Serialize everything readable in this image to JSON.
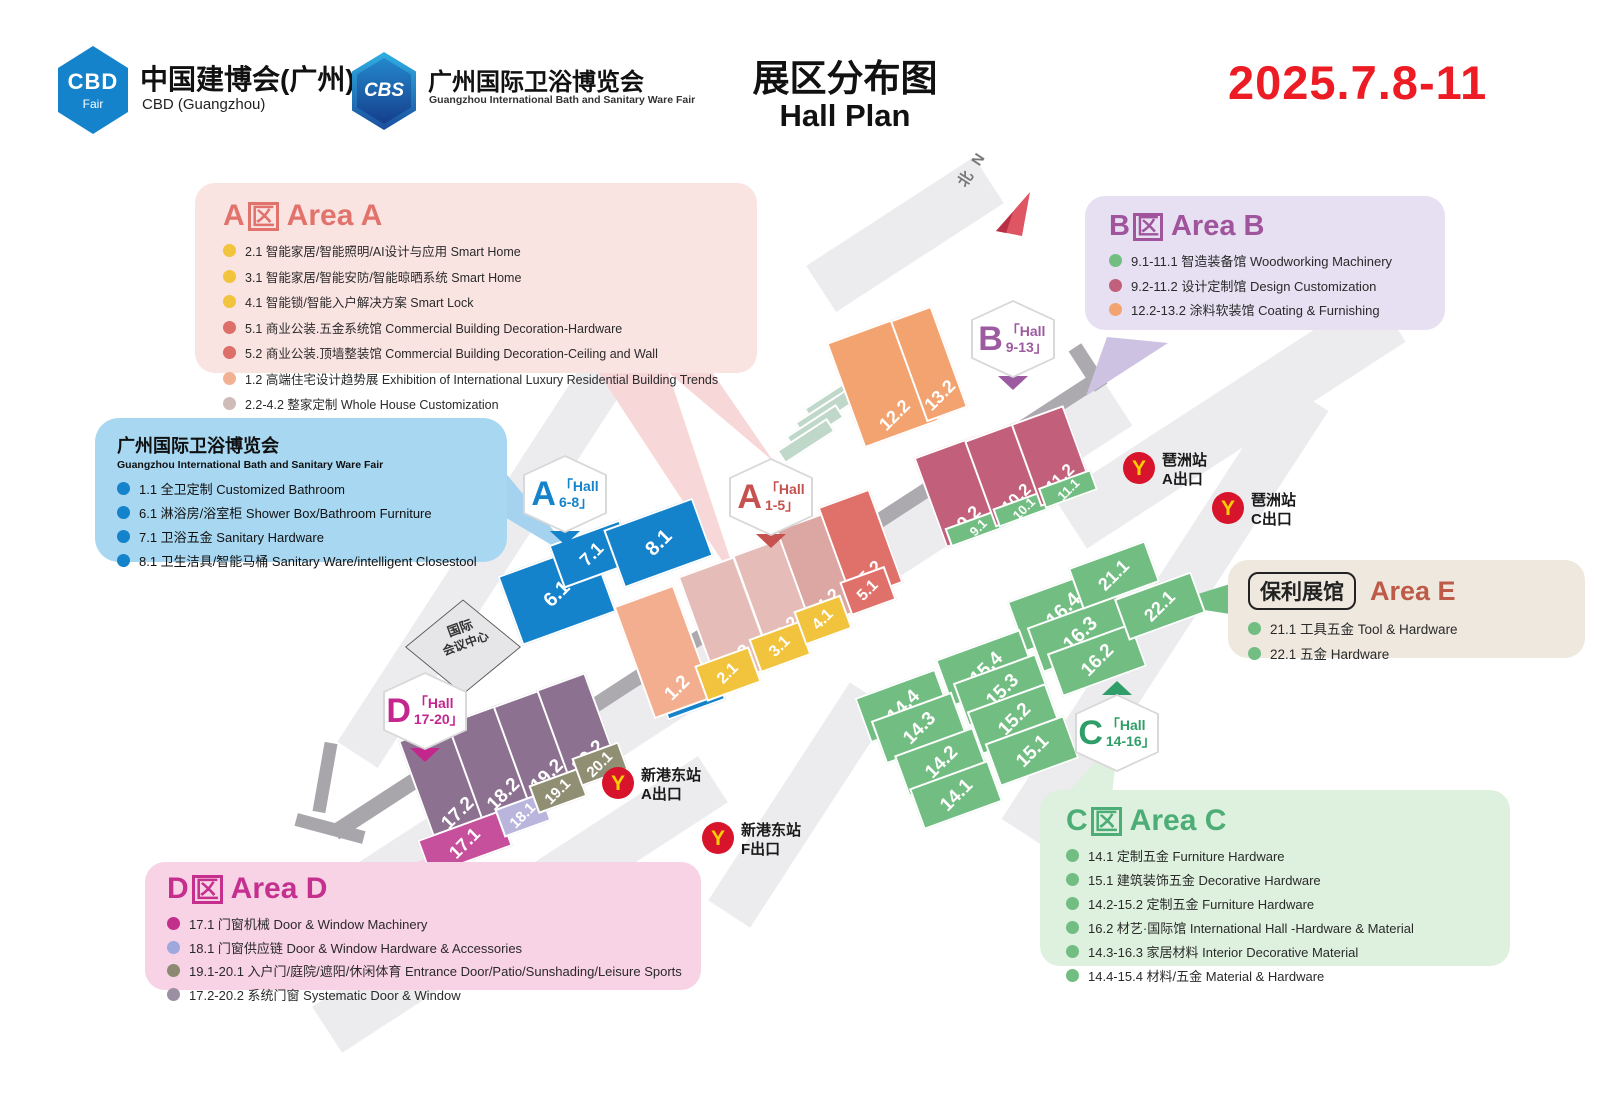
{
  "header": {
    "cbd_logo": {
      "text": "CBD",
      "sub": "Fair"
    },
    "cbd_title": "中国建博会(广州)",
    "cbd_subtitle": "CBD (Guangzhou)",
    "cbs_logo": "CBS",
    "cbs_title": "广州国际卫浴博览会",
    "cbs_subtitle": "Guangzhou International Bath and Sanitary Ware Fair",
    "title_zh": "展区分布图",
    "title_en": "Hall Plan",
    "date": "2025.7.8-11"
  },
  "legends": {
    "a": {
      "letter": "A",
      "qu": "区",
      "title": "Area A",
      "items": [
        {
          "color": "#F2C33D",
          "text": "2.1 智能家居/智能照明/AI设计与应用 Smart Home"
        },
        {
          "color": "#F2C33D",
          "text": "3.1 智能家居/智能安防/智能晾晒系统 Smart Home"
        },
        {
          "color": "#F2C33D",
          "text": "4.1 智能锁/智能入户解决方案 Smart Lock"
        },
        {
          "color": "#DD6E68",
          "text": "5.1 商业公装.五金系统馆 Commercial Building Decoration-Hardware"
        },
        {
          "color": "#DD6E68",
          "text": "5.2 商业公装.顶墙整装馆 Commercial Building Decoration-Ceiling and Wall"
        },
        {
          "color": "#F2B193",
          "text": "1.2 高端住宅设计趋势展 Exhibition of International Luxury Residential Building Trends"
        },
        {
          "color": "#CFBCB9",
          "text": "2.2-4.2 整家定制 Whole House Customization"
        }
      ]
    },
    "bath": {
      "title": "广州国际卫浴博览会",
      "subtitle": "Guangzhou International Bath and Sanitary Ware Fair",
      "items": [
        {
          "color": "#1583CB",
          "text": "1.1 全卫定制 Customized Bathroom"
        },
        {
          "color": "#1583CB",
          "text": "6.1 淋浴房/浴室柜 Shower Box/Bathroom Furniture"
        },
        {
          "color": "#1583CB",
          "text": "7.1 卫浴五金 Sanitary Hardware"
        },
        {
          "color": "#1583CB",
          "text": "8.1 卫生洁具/智能马桶 Sanitary Ware/intelligent Closestool"
        }
      ]
    },
    "b": {
      "letter": "B",
      "qu": "区",
      "title": "Area B",
      "items": [
        {
          "color": "#72BE82",
          "text": "9.1-11.1 智造装备馆 Woodworking Machinery"
        },
        {
          "color": "#C2607C",
          "text": "9.2-11.2 设计定制馆 Design Customization"
        },
        {
          "color": "#F3A370",
          "text": "12.2-13.2 涂料软装馆 Coating & Furnishing"
        }
      ]
    },
    "e": {
      "pill": "保利展馆",
      "title": "Area E",
      "items": [
        {
          "color": "#72BE82",
          "text": "21.1 工具五金 Tool & Hardware"
        },
        {
          "color": "#72BE82",
          "text": "22.1 五金 Hardware"
        }
      ]
    },
    "c": {
      "letter": "C",
      "qu": "区",
      "title": "Area C",
      "items": [
        {
          "color": "#72BE82",
          "text": "14.1 定制五金 Furniture Hardware"
        },
        {
          "color": "#72BE82",
          "text": "15.1 建筑装饰五金 Decorative Hardware"
        },
        {
          "color": "#72BE82",
          "text": "14.2-15.2 定制五金 Furniture Hardware"
        },
        {
          "color": "#72BE82",
          "text": "16.2 材艺·国际馆 International Hall -Hardware & Material"
        },
        {
          "color": "#72BE82",
          "text": "14.3-16.3 家居材料 Interior Decorative Material"
        },
        {
          "color": "#72BE82",
          "text": "14.4-15.4 材料/五金 Material & Hardware"
        }
      ]
    },
    "d": {
      "letter": "D",
      "qu": "区",
      "title": "Area D",
      "items": [
        {
          "color": "#C2308C",
          "text": "17.1 门窗机械 Door & Window Machinery"
        },
        {
          "color": "#9FA8DC",
          "text": "18.1 门窗供应链 Door & Window Hardware & Accessories"
        },
        {
          "color": "#8B8A70",
          "text": "19.1-20.1 入户门/庭院/遮阳/休闲体育 Entrance Door/Patio/Sunshading/Leisure Sports"
        },
        {
          "color": "#9B8FA3",
          "text": "17.2-20.2 系统门窗 Systematic Door & Window"
        }
      ]
    }
  },
  "map": {
    "north": "北 N",
    "convention_center": {
      "line1": "国际",
      "line2": "会议中心"
    },
    "halls": [
      {
        "label": "6.1",
        "x": 557,
        "y": 594,
        "w": 100,
        "h": 74,
        "c": "#1583CB",
        "fs": 20
      },
      {
        "label": "7.1",
        "x": 592,
        "y": 554,
        "w": 76,
        "h": 46,
        "c": "#1583CB",
        "fs": 18
      },
      {
        "label": "8.1",
        "x": 658,
        "y": 543,
        "w": 95,
        "h": 62,
        "c": "#1583CB",
        "fs": 20
      },
      {
        "label": "1.1",
        "x": 692,
        "y": 696,
        "w": 62,
        "h": 30,
        "c": "#1583CB",
        "fs": 15
      },
      {
        "label": "1.2",
        "x": 664,
        "y": 652,
        "w": 64,
        "h": 120,
        "c": "#F3AE8F",
        "fs": 19,
        "lp": "b"
      },
      {
        "label": "2.2",
        "x": 726,
        "y": 622,
        "w": 60,
        "h": 118,
        "c": "#E5BCB8",
        "fs": 19,
        "lp": "b"
      },
      {
        "label": "2.1",
        "x": 728,
        "y": 674,
        "w": 58,
        "h": 38,
        "c": "#F2C33D",
        "fs": 16
      },
      {
        "label": "3.2",
        "x": 776,
        "y": 597,
        "w": 54,
        "h": 108,
        "c": "#E5BCB8",
        "fs": 18,
        "lp": "b"
      },
      {
        "label": "3.1",
        "x": 780,
        "y": 647,
        "w": 54,
        "h": 36,
        "c": "#F2C33D",
        "fs": 16
      },
      {
        "label": "4.2",
        "x": 818,
        "y": 570,
        "w": 52,
        "h": 105,
        "c": "#DCA7A2",
        "fs": 18,
        "lp": "b"
      },
      {
        "label": "4.1",
        "x": 823,
        "y": 620,
        "w": 50,
        "h": 36,
        "c": "#F2C33D",
        "fs": 16
      },
      {
        "label": "5.2",
        "x": 860,
        "y": 545,
        "w": 55,
        "h": 100,
        "c": "#E0716A",
        "fs": 18,
        "lp": "b"
      },
      {
        "label": "5.1",
        "x": 868,
        "y": 591,
        "w": 48,
        "h": 36,
        "c": "#E0716A",
        "fs": 16
      },
      {
        "label": "12.2",
        "x": 883,
        "y": 382,
        "w": 80,
        "h": 112,
        "c": "#F3A370",
        "fs": 18,
        "lp": "b"
      },
      {
        "label": "13.2",
        "x": 929,
        "y": 364,
        "w": 44,
        "h": 108,
        "c": "#F3A370",
        "fs": 18,
        "lp": "b"
      },
      {
        "label": "9.2",
        "x": 960,
        "y": 492,
        "w": 64,
        "h": 96,
        "c": "#C2607C",
        "fs": 18,
        "lp": "b"
      },
      {
        "label": "9.1",
        "x": 978,
        "y": 527,
        "w": 64,
        "h": 20,
        "c": "#72BE82",
        "fs": 13
      },
      {
        "label": "10.2",
        "x": 1008,
        "y": 474,
        "w": 60,
        "h": 92,
        "c": "#C2607C",
        "fs": 17,
        "lp": "b"
      },
      {
        "label": "10.1",
        "x": 1024,
        "y": 508,
        "w": 60,
        "h": 20,
        "c": "#72BE82",
        "fs": 13
      },
      {
        "label": "11.2",
        "x": 1052,
        "y": 456,
        "w": 56,
        "h": 88,
        "c": "#C2607C",
        "fs": 17,
        "lp": "b"
      },
      {
        "label": "11.1",
        "x": 1068,
        "y": 489,
        "w": 56,
        "h": 22,
        "c": "#72BE82",
        "fs": 13
      },
      {
        "label": "16.4",
        "x": 1063,
        "y": 610,
        "w": 100,
        "h": 54,
        "c": "#72BE82",
        "fs": 20
      },
      {
        "label": "16.3",
        "x": 1080,
        "y": 634,
        "w": 96,
        "h": 48,
        "c": "#72BE82",
        "fs": 20
      },
      {
        "label": "16.2",
        "x": 1097,
        "y": 660,
        "w": 90,
        "h": 46,
        "c": "#72BE82",
        "fs": 19
      },
      {
        "label": "15.4",
        "x": 986,
        "y": 668,
        "w": 90,
        "h": 50,
        "c": "#72BE82",
        "fs": 19
      },
      {
        "label": "15.3",
        "x": 1002,
        "y": 690,
        "w": 88,
        "h": 46,
        "c": "#72BE82",
        "fs": 19
      },
      {
        "label": "15.2",
        "x": 1014,
        "y": 719,
        "w": 84,
        "h": 46,
        "c": "#72BE82",
        "fs": 19
      },
      {
        "label": "15.1",
        "x": 1032,
        "y": 751,
        "w": 84,
        "h": 46,
        "c": "#72BE82",
        "fs": 19
      },
      {
        "label": "14.4",
        "x": 903,
        "y": 706,
        "w": 86,
        "h": 48,
        "c": "#72BE82",
        "fs": 19
      },
      {
        "label": "14.3",
        "x": 919,
        "y": 728,
        "w": 86,
        "h": 46,
        "c": "#72BE82",
        "fs": 19
      },
      {
        "label": "14.2",
        "x": 941,
        "y": 762,
        "w": 84,
        "h": 44,
        "c": "#72BE82",
        "fs": 19
      },
      {
        "label": "14.1",
        "x": 956,
        "y": 795,
        "w": 84,
        "h": 44,
        "c": "#72BE82",
        "fs": 19
      },
      {
        "label": "21.1",
        "x": 1114,
        "y": 575,
        "w": 82,
        "h": 44,
        "c": "#72BE82",
        "fs": 18
      },
      {
        "label": "22.1",
        "x": 1160,
        "y": 606,
        "w": 82,
        "h": 44,
        "c": "#72BE82",
        "fs": 18
      },
      {
        "label": "17.2",
        "x": 446,
        "y": 782,
        "w": 62,
        "h": 110,
        "c": "#8C7191",
        "fs": 19,
        "lp": "b"
      },
      {
        "label": "18.2",
        "x": 492,
        "y": 764,
        "w": 58,
        "h": 108,
        "c": "#8C7191",
        "fs": 19,
        "lp": "b"
      },
      {
        "label": "19.2",
        "x": 536,
        "y": 746,
        "w": 55,
        "h": 105,
        "c": "#8C7191",
        "fs": 19,
        "lp": "b"
      },
      {
        "label": "20.2",
        "x": 578,
        "y": 729,
        "w": 52,
        "h": 102,
        "c": "#8C7191",
        "fs": 19,
        "lp": "b"
      },
      {
        "label": "17.1",
        "x": 465,
        "y": 843,
        "w": 88,
        "h": 38,
        "c": "#C7509C",
        "fs": 18
      },
      {
        "label": "18.1",
        "x": 523,
        "y": 815,
        "w": 50,
        "h": 30,
        "c": "#B9B5DD",
        "fs": 15
      },
      {
        "label": "19.1",
        "x": 558,
        "y": 791,
        "w": 52,
        "h": 30,
        "c": "#908F74",
        "fs": 15
      },
      {
        "label": "20.1",
        "x": 600,
        "y": 764,
        "w": 50,
        "h": 30,
        "c": "#908F74",
        "fs": 15
      }
    ],
    "badges": [
      {
        "letter": "A",
        "l1": "「Hall",
        "l2": "6-8」",
        "c": "#1583CB",
        "x": 565,
        "y": 494,
        "tri": "b"
      },
      {
        "letter": "A",
        "l1": "「Hall",
        "l2": "1-5」",
        "c": "#C5524E",
        "x": 771,
        "y": 497,
        "tri": "b"
      },
      {
        "letter": "B",
        "l1": "「Hall",
        "l2": "9-13」",
        "c": "#9C5BA0",
        "x": 1013,
        "y": 339,
        "tri": "b"
      },
      {
        "letter": "C",
        "l1": "「Hall",
        "l2": "14-16」",
        "c": "#2F9E68",
        "x": 1117,
        "y": 733,
        "tri": "t"
      },
      {
        "letter": "D",
        "l1": "「Hall",
        "l2": "17-20」",
        "c": "#C3278E",
        "x": 425,
        "y": 711,
        "tri": "b"
      }
    ],
    "metros": [
      {
        "name": "琶洲站",
        "exit": "A出口",
        "x": 1123,
        "y": 452
      },
      {
        "name": "琶洲站",
        "exit": "C出口",
        "x": 1212,
        "y": 492
      },
      {
        "name": "新港东站",
        "exit": "A出口",
        "x": 602,
        "y": 767
      },
      {
        "name": "新港东站",
        "exit": "F出口",
        "x": 702,
        "y": 822
      }
    ]
  }
}
